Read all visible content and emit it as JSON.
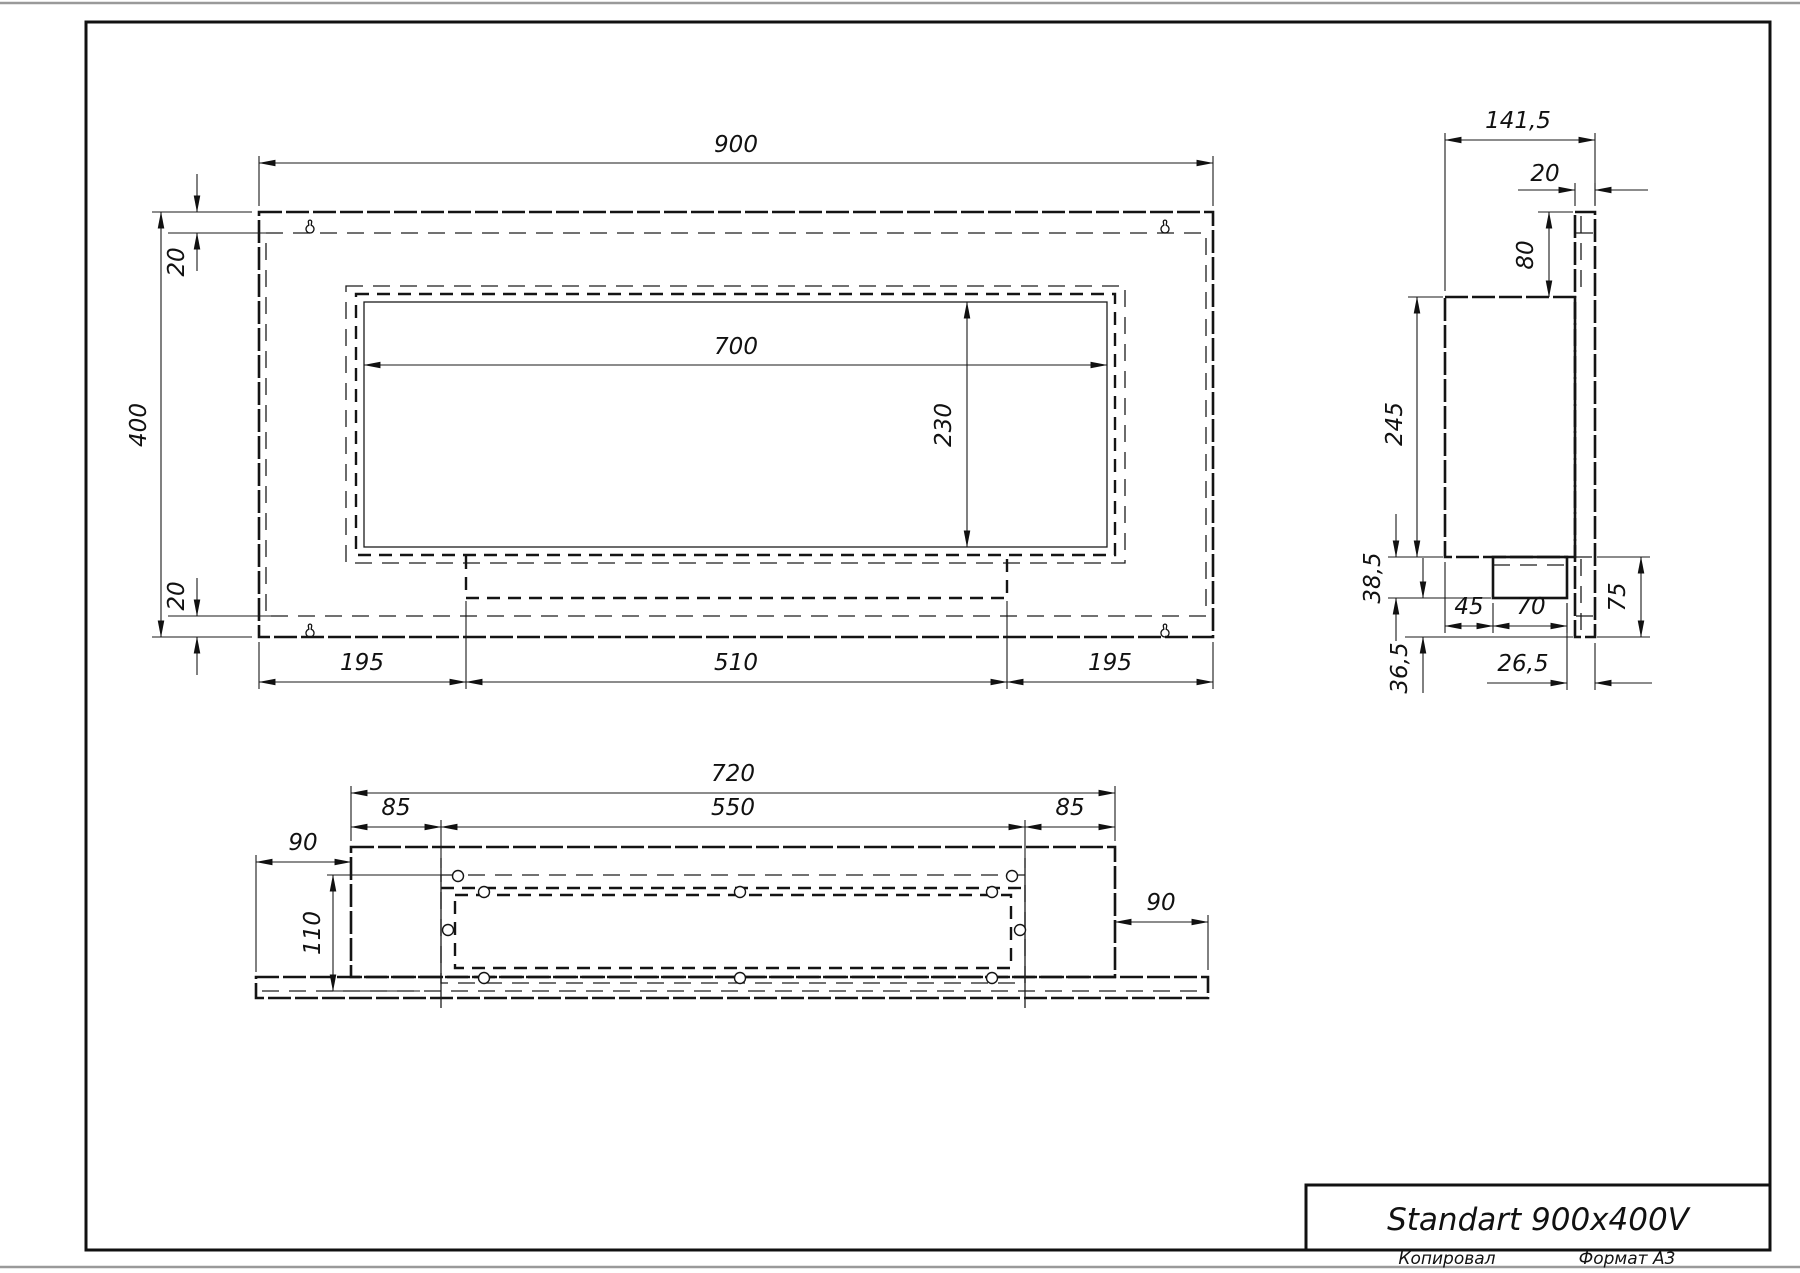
{
  "title_block": {
    "title": "Standart 900x400V"
  },
  "page_footer": {
    "copied": "Копировал",
    "format": "Формат A3"
  },
  "front_view": {
    "dims": {
      "overall_width": "900",
      "overall_height": "400",
      "top_flange": "20",
      "bottom_flange": "20",
      "opening_width": "700",
      "opening_height": "230",
      "left_offset": "195",
      "burner_width": "510",
      "right_offset": "195"
    }
  },
  "side_view": {
    "dims": {
      "overall_depth": "141,5",
      "front_panel_thickness": "20",
      "top_inset": "80",
      "body_height": "245",
      "tray_depth": "38,5",
      "tray_left_offset": "45",
      "tray_width": "70",
      "bottom_right_height": "75",
      "tray_to_front": "26,5",
      "bottom_inset": "36,5"
    }
  },
  "bottom_view": {
    "dims": {
      "body_width": "720",
      "left_hole_offset": "85",
      "hole_span": "550",
      "right_hole_offset": "85",
      "left_overhang": "90",
      "pattern_depth": "110",
      "right_overhang": "90"
    }
  }
}
